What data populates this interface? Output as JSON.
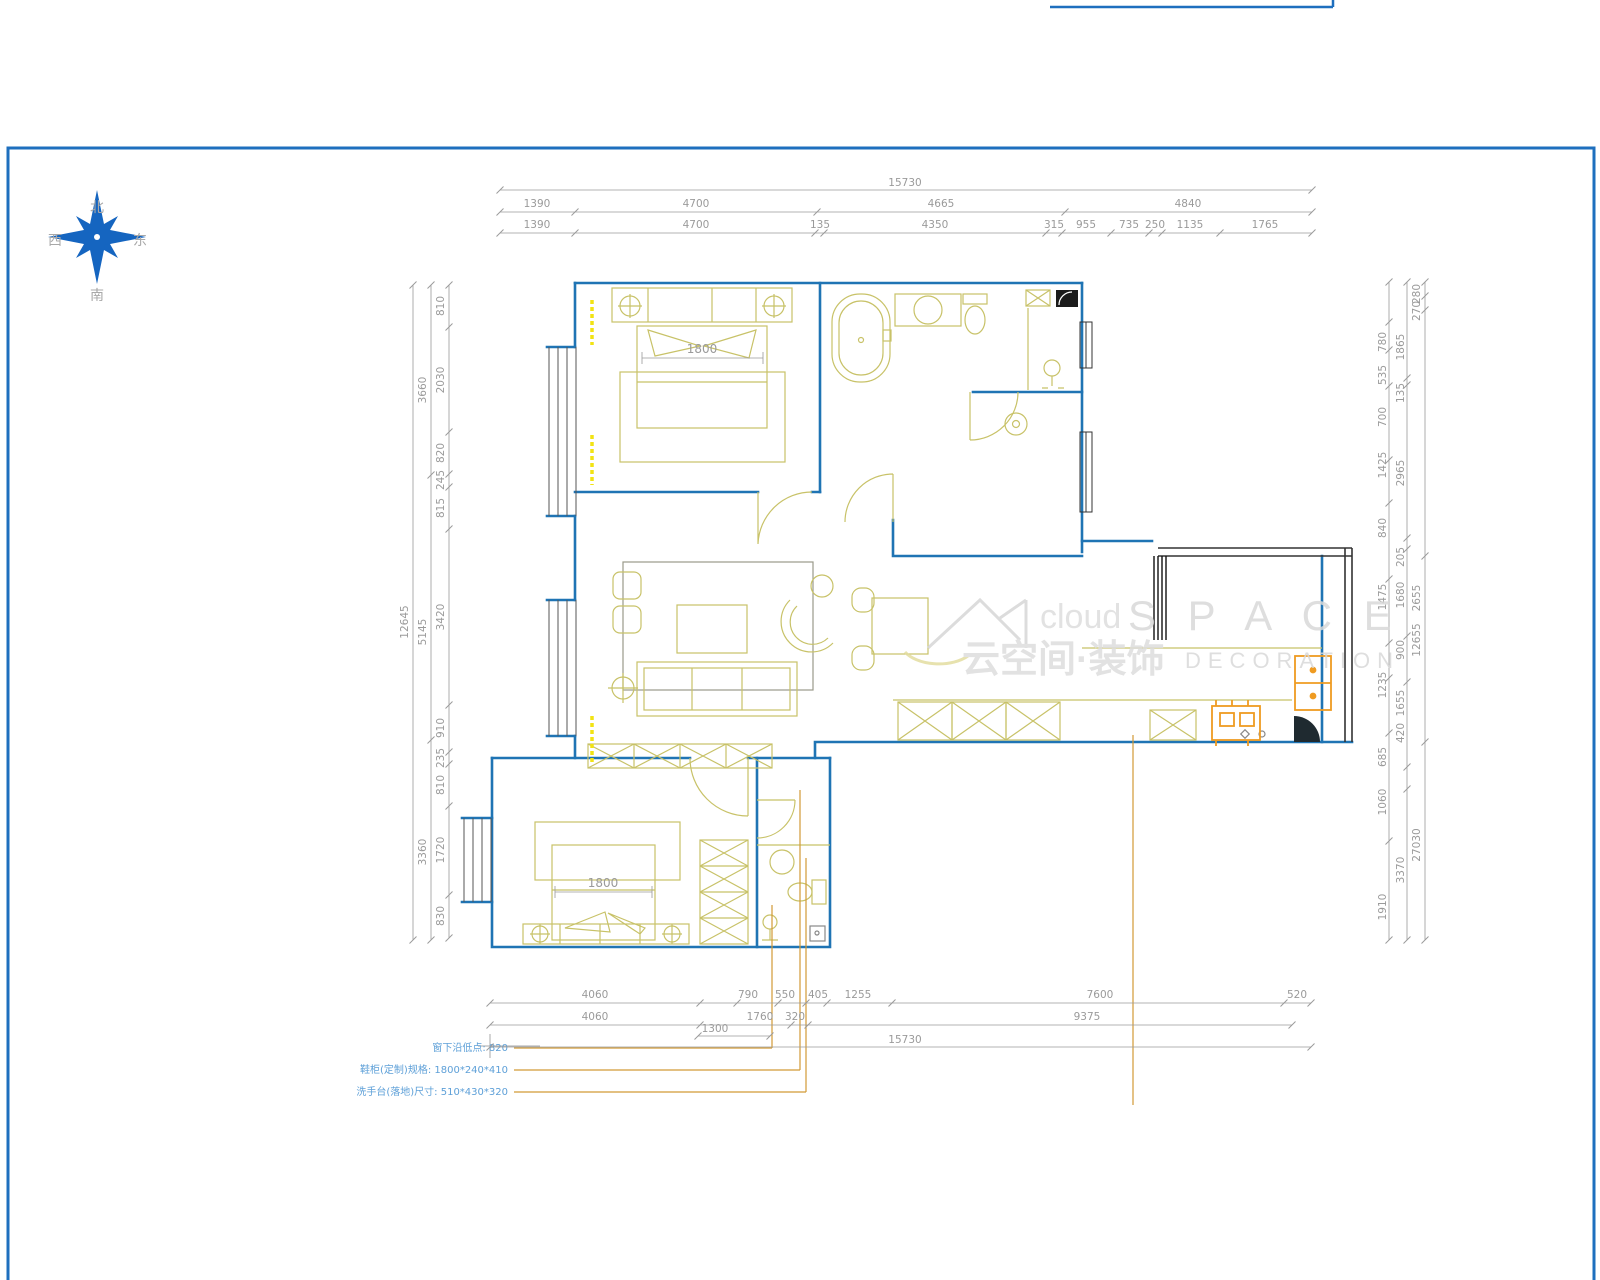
{
  "compass": {
    "north": "北",
    "south": "南",
    "west": "西",
    "east": "东"
  },
  "watermark": {
    "word_light": "cloud",
    "word_main": "S P A C E",
    "line2_cn": "云空间·装饰",
    "line2_en": "DECORATION"
  },
  "plan_labels": {
    "bed1_width": "1800",
    "bed2_width": "1800"
  },
  "dims": {
    "top": {
      "total": "15730",
      "row2": [
        "1390",
        "4700",
        "4665",
        "4840"
      ],
      "row3": [
        "1390",
        "4700",
        "135",
        "4350",
        "315",
        "955",
        "735",
        "250",
        "1135",
        "1765"
      ]
    },
    "bottom": {
      "row1": [
        "4060",
        "790",
        "550",
        "405",
        "1255",
        "7600",
        "520"
      ],
      "row2": [
        "4060",
        "1760",
        "320",
        "9375"
      ],
      "sub": "1300",
      "total": "15730"
    },
    "left": {
      "total": "12645",
      "mid": [
        "3660",
        "5145",
        "3360"
      ],
      "inner": [
        "810",
        "2030",
        "820",
        "245",
        "815",
        "3420",
        "910",
        "235",
        "810",
        "1720",
        "830"
      ]
    },
    "right": {
      "inner": [
        "780",
        "535",
        "700",
        "1425",
        "840",
        "1475",
        "1235",
        "685",
        "1060",
        "1910"
      ],
      "mid": [
        "1865",
        "135",
        "2965",
        "205",
        "1680",
        "900",
        "1655",
        "420",
        "3370"
      ],
      "outer": [
        "280",
        "270",
        "2655",
        "12655",
        "27030"
      ]
    }
  },
  "annotations": [
    "窗下沿低点: 820",
    "鞋柜(定制)规格: 1800*240*410",
    "洗手台(落地)尺寸: 510*430*320"
  ],
  "colors": {
    "wall": "#1f74b4",
    "furniture": "#c8c268",
    "appliance_orange": "#ef9b21",
    "radiator_yellow": "#f2e313",
    "dim_gray": "#9a9a9a",
    "annotation_blue": "#5ea0d8",
    "leader": "#d29a36",
    "watermark": "#e0e0e0"
  }
}
